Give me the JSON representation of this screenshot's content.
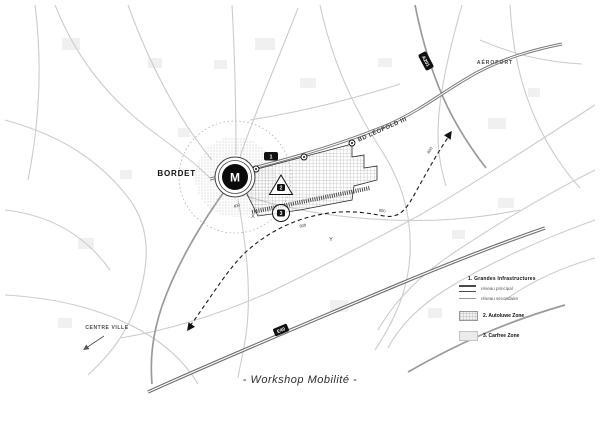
{
  "map": {
    "station": {
      "name": "BORDET",
      "metro_symbol": "M"
    },
    "roads": {
      "boulevard": "BD LÉOPOLD III",
      "motorway_ne": "A201",
      "motorway_s": "E40"
    },
    "directions": {
      "airport": "AÉROPORT",
      "city_center": "CENTRE VILLE"
    },
    "markers": {
      "m1": "1",
      "m2": "2",
      "m3": "3"
    },
    "waypoints": {
      "x": "X",
      "y": "Y"
    },
    "distance_labels": [
      "400",
      "600",
      "600",
      "600"
    ]
  },
  "legend": {
    "section1_title": "1. Grandes Infrastructures",
    "items": [
      {
        "label": "réseau principal"
      },
      {
        "label": "réseau secondaire"
      }
    ],
    "section2_title": "2. Autoluwe Zone",
    "section3_title": "3. Carfree Zone"
  },
  "caption": "- Workshop Mobilité -",
  "colors": {
    "paper": "#ffffff",
    "road_light": "#cccccc",
    "road_medium": "#9a9a9a",
    "road_dark": "#757575",
    "accent_black": "#111111"
  }
}
